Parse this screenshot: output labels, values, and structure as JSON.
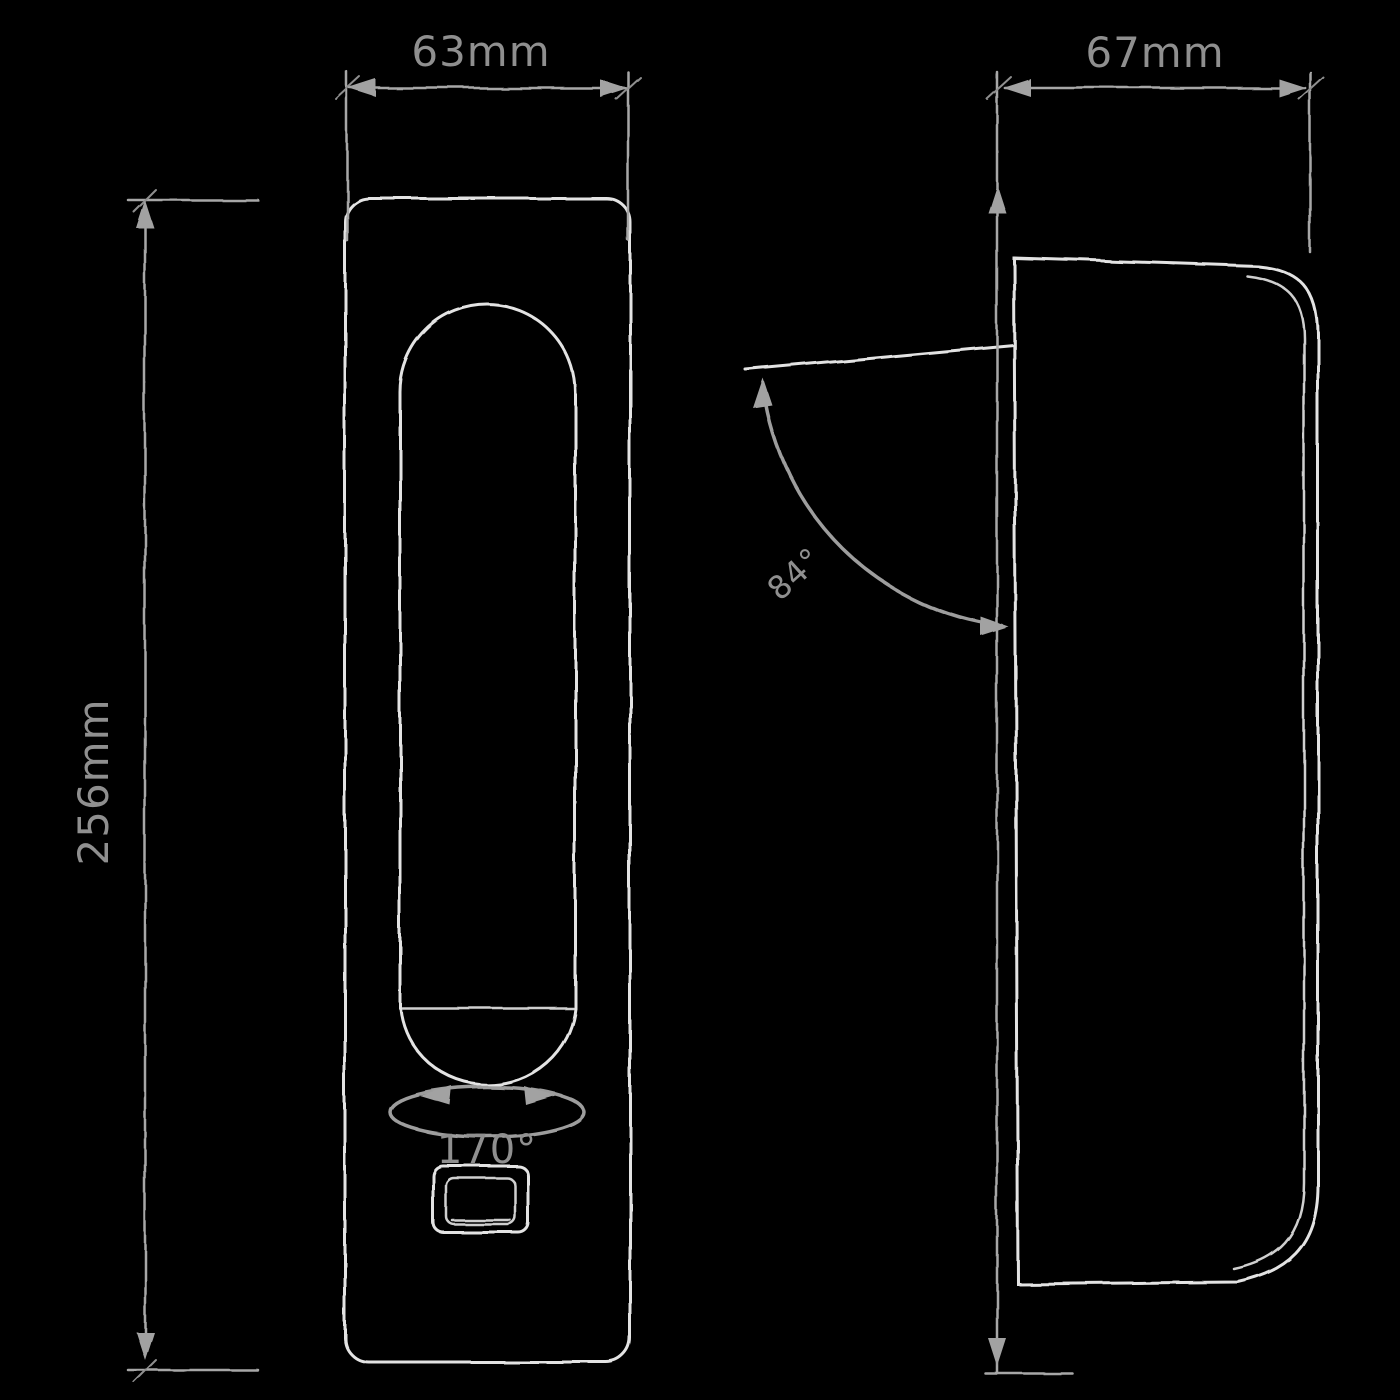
{
  "drawing": {
    "background": "#000000",
    "outline_color": "#e3e3e3",
    "dimension_color": "#a7a7a7",
    "label_color": "#8f8f8f",
    "views": {
      "front": {
        "width": "63mm",
        "height": "256mm",
        "knob_rotation": "170°"
      },
      "side": {
        "depth": "67mm",
        "opening_angle": "84°"
      }
    }
  }
}
